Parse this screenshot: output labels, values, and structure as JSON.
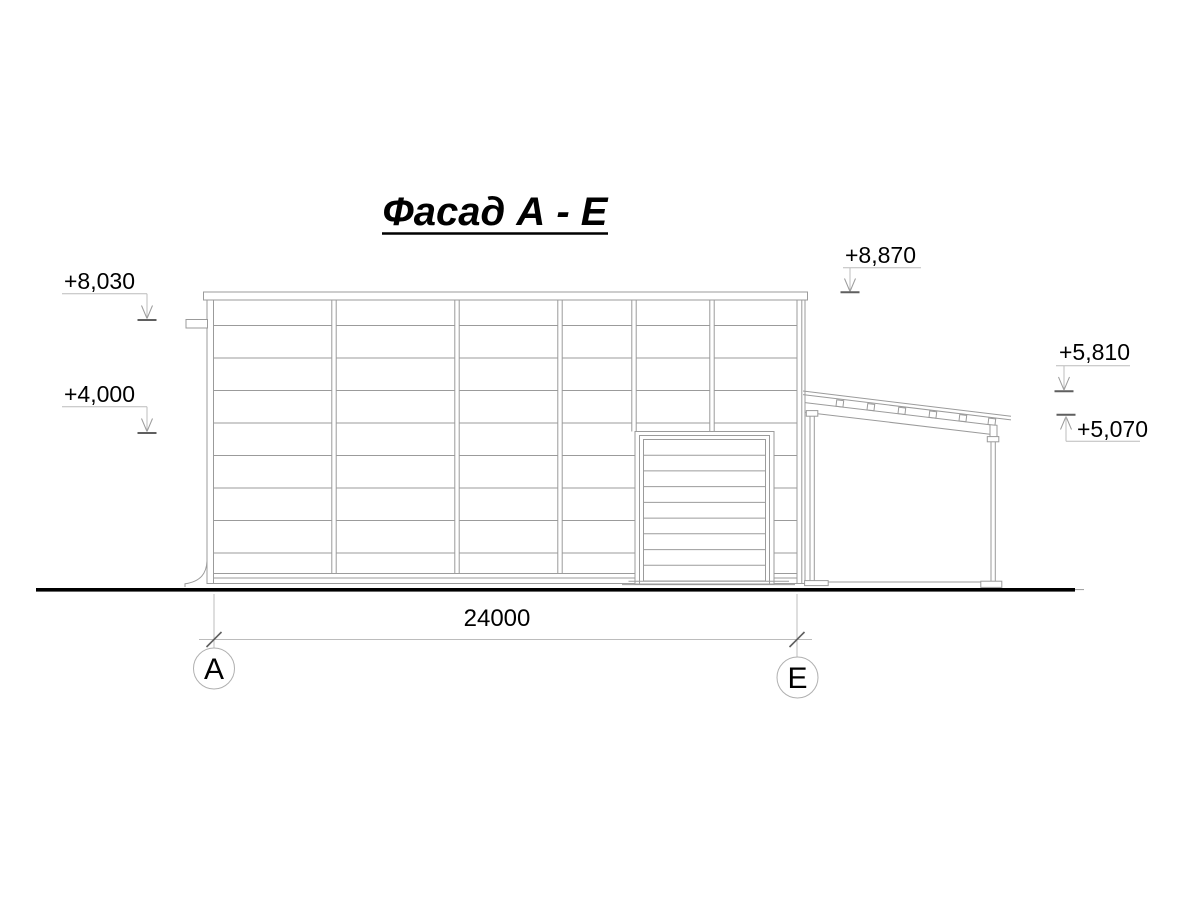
{
  "drawing": {
    "title": "Фасад А - Е",
    "type_note": "architectural facade elevation",
    "colors": {
      "line": "#9b9b9b",
      "line_light": "#bcbcbc",
      "tick_dark": "#5f5f5f",
      "ground": "#000000",
      "text": "#000000",
      "background": "#ffffff"
    },
    "elevation_markers": [
      {
        "id": "left-upper",
        "label": "+8,030"
      },
      {
        "id": "left-lower",
        "label": "+4,000"
      },
      {
        "id": "parapet-top",
        "label": "+8,870"
      },
      {
        "id": "annex-roof-high",
        "label": "+5,810"
      },
      {
        "id": "annex-roof-low",
        "label": "+5,070"
      }
    ],
    "dimension": {
      "label": "24000"
    },
    "axis_markers": [
      {
        "id": "axis-a",
        "label": "А"
      },
      {
        "id": "axis-e",
        "label": "Е"
      }
    ]
  }
}
